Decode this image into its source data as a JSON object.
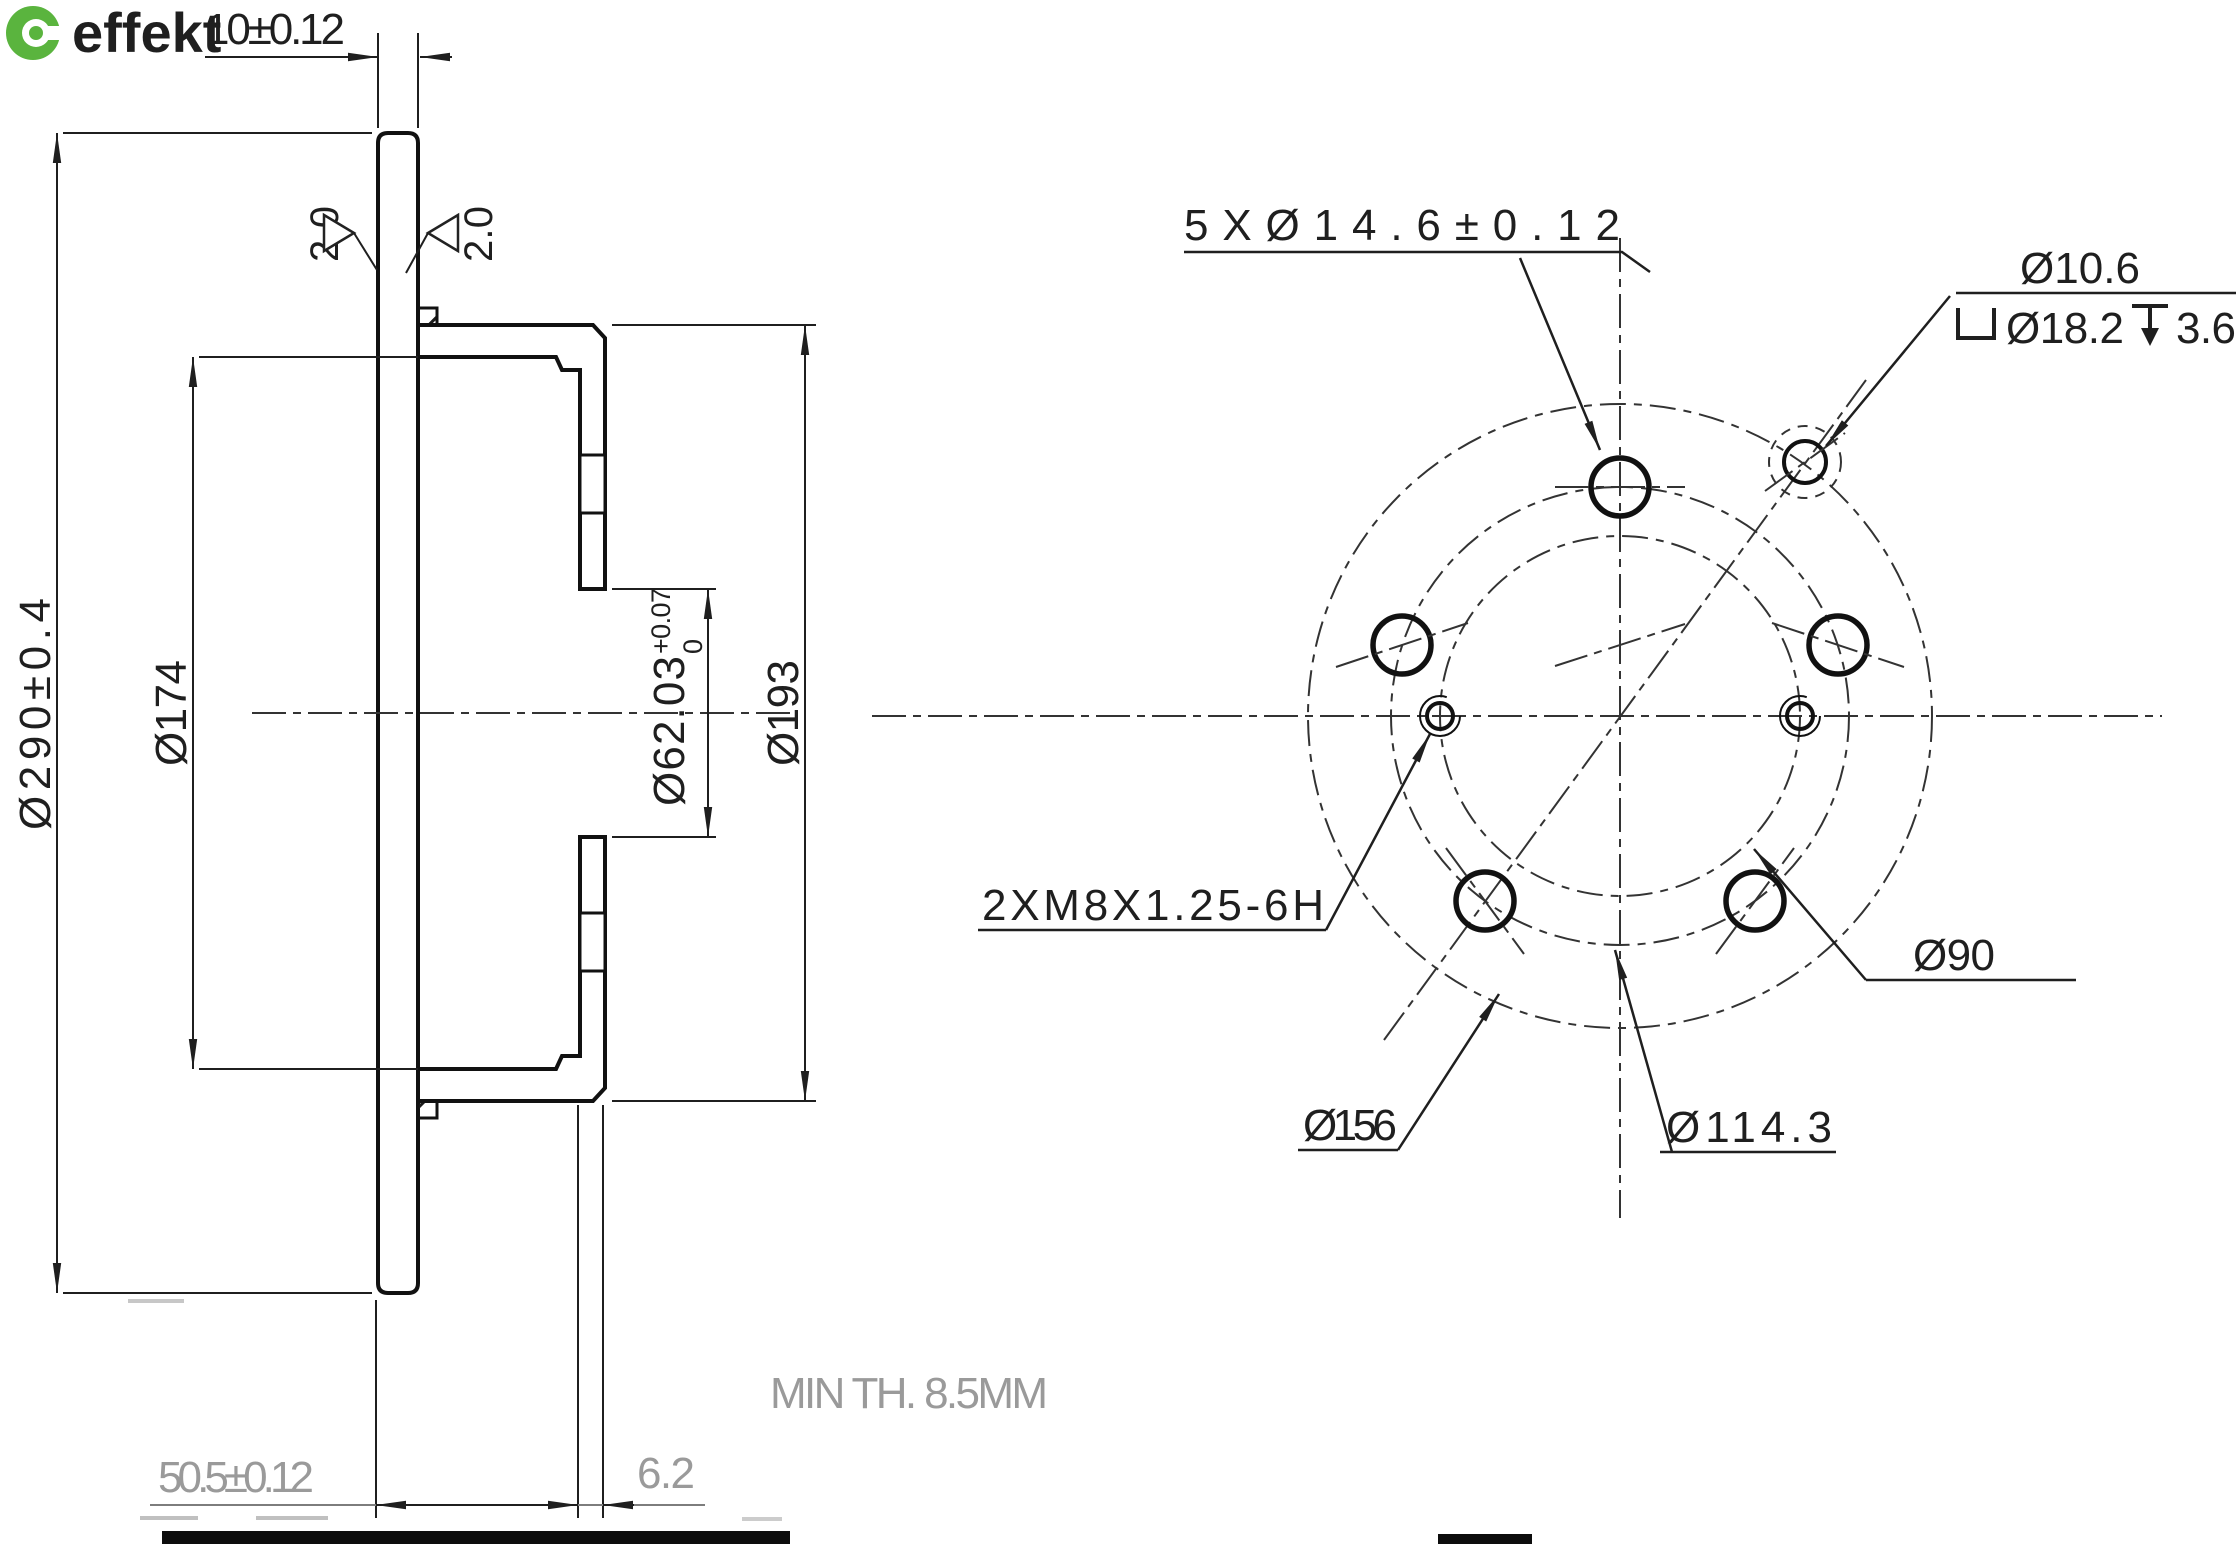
{
  "logo": {
    "text": "effekt",
    "color": "#5ab43e"
  },
  "icons": {
    "logo_icon": "wrench-circle-icon",
    "counterbore": "counterbore-icon",
    "depth": "depth-icon"
  },
  "colors": {
    "line": "#1a1a1a",
    "accent_green": "#5ab43e",
    "muted_gray": "#9a9a9a"
  },
  "labels": {
    "plate_thickness": "10±0.12",
    "chamfer_left": "2.0",
    "chamfer_right": "2.0",
    "outer_diameter": "Ø290±0.4",
    "hat_inner_diameter": "Ø174",
    "hat_outer_diameter": "Ø193",
    "bore_diameter": "Ø62.03",
    "bore_tolerance_upper": "+0.07",
    "bore_tolerance_lower": "0",
    "overall_height": "50.5±0.12",
    "hub_wall_thickness": "6.2",
    "min_thickness_note": "MIN TH. 8.5MM",
    "bolt_holes": "5XØ14.6±0.12",
    "screw_hole_diameter": "Ø10.6",
    "counterbore_diameter": "Ø18.2",
    "counterbore_depth": "3.6",
    "thread_spec": "2XM8X1.25-6H",
    "pilot_circle_diameter": "Ø90",
    "outer_ring_diameter": "Ø156",
    "bolt_circle_diameter": "Ø114.3"
  }
}
